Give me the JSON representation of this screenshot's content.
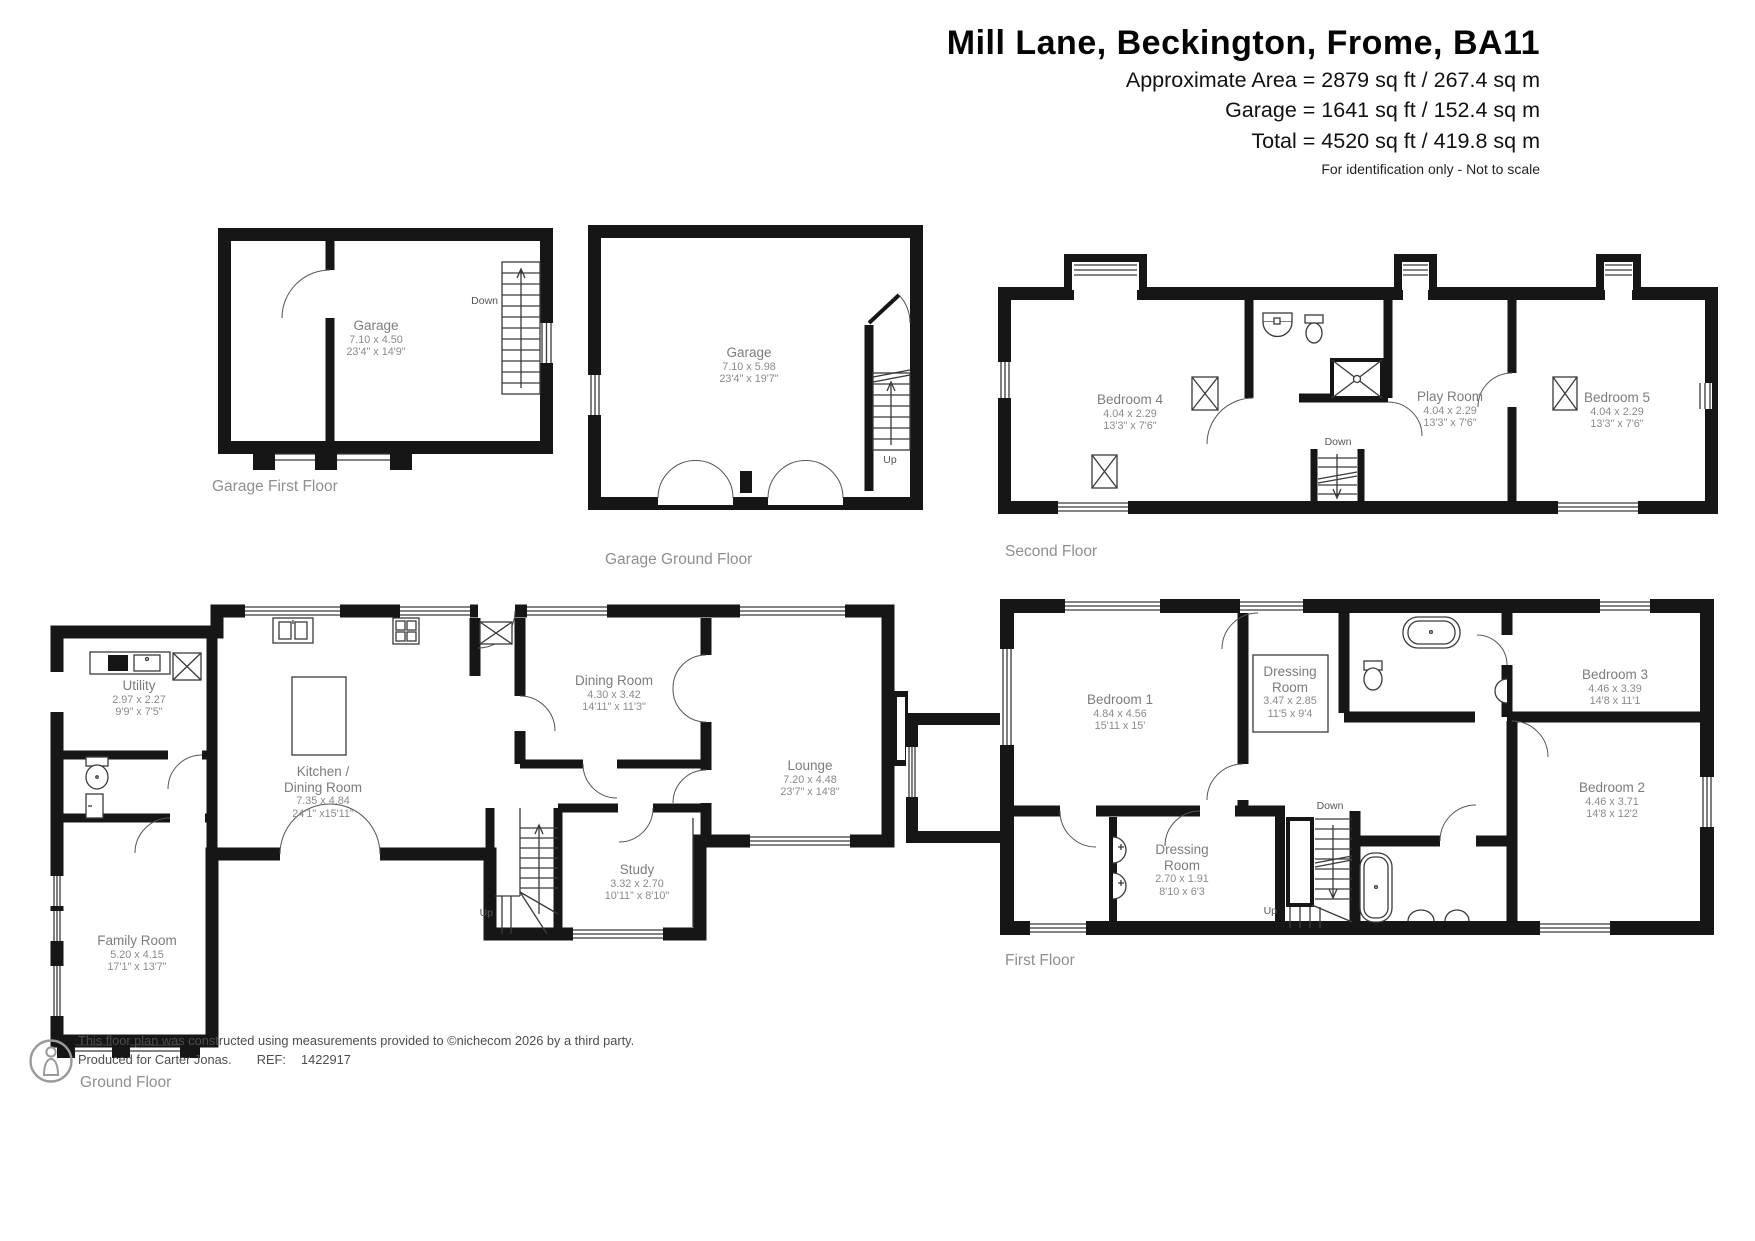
{
  "header": {
    "title": "Mill Lane, Beckington, Frome, BA11",
    "area_lines": [
      "Approximate Area = 2879 sq ft / 267.4 sq m",
      "Garage = 1641 sq ft / 152.4 sq m",
      "Total = 4520 sq ft / 419.8 sq m"
    ],
    "note": "For identification only - Not to scale"
  },
  "labels": {
    "up": "Up",
    "down": "Down"
  },
  "plans": {
    "garage_first_floor": {
      "caption": "Garage First Floor",
      "rooms": [
        {
          "line1": "Garage",
          "metric": "7.10 x 4.50",
          "imperial": "23'4\" x 14'9\""
        }
      ]
    },
    "garage_ground_floor": {
      "caption": "Garage Ground Floor",
      "rooms": [
        {
          "line1": "Garage",
          "metric": "7.10 x 5.98",
          "imperial": "23'4\" x 19'7\""
        }
      ]
    },
    "second_floor": {
      "caption": "Second Floor",
      "rooms": [
        {
          "line1": "Bedroom 4",
          "metric": "4.04 x 2.29",
          "imperial": "13'3\" x 7'6\""
        },
        {
          "line1": "Play Room",
          "metric": "4.04 x 2.29",
          "imperial": "13'3\" x 7'6\""
        },
        {
          "line1": "Bedroom 5",
          "metric": "4.04 x 2.29",
          "imperial": "13'3\" x 7'6\""
        }
      ]
    },
    "ground_floor": {
      "caption": "Ground Floor",
      "rooms": [
        {
          "line1": "Utility",
          "metric": "2.97 x 2.27",
          "imperial": "9'9\" x 7'5\""
        },
        {
          "line1": "Kitchen /",
          "line2": "Dining Room",
          "metric": "7.35 x 4.84",
          "imperial": "24'1\" x15'11\""
        },
        {
          "line1": "Dining Room",
          "metric": "4.30 x 3.42",
          "imperial": "14'11\" x 11'3\""
        },
        {
          "line1": "Lounge",
          "metric": "7.20 x 4.48",
          "imperial": "23'7\" x 14'8\""
        },
        {
          "line1": "Study",
          "metric": "3.32 x 2.70",
          "imperial": "10'11\" x 8'10\""
        },
        {
          "line1": "Family Room",
          "metric": "5.20 x 4.15",
          "imperial": "17'1\" x 13'7\""
        }
      ]
    },
    "first_floor": {
      "caption": "First Floor",
      "rooms": [
        {
          "line1": "Bedroom 1",
          "metric": "4.84 x 4.56",
          "imperial": "15'11 x 15'"
        },
        {
          "line1": "Dressing",
          "line2": "Room",
          "metric": "3.47 x 2.85",
          "imperial": "11'5 x 9'4"
        },
        {
          "line1": "Bedroom 3",
          "metric": "4.46 x 3.39",
          "imperial": "14'8 x 11'1"
        },
        {
          "line1": "Dressing",
          "line2": "Room",
          "metric": "2.70 x 1.91",
          "imperial": "8'10 x 6'3"
        },
        {
          "line1": "Bedroom 2",
          "metric": "4.46 x 3.71",
          "imperial": "14'8 x 12'2"
        }
      ]
    }
  },
  "footer": {
    "line1": "This floor plan was constructed using measurements provided to ©nichecom 2026 by a third party.",
    "line2_prefix": "Produced for Carter Jonas.",
    "ref_label": "REF:",
    "ref_value": "1422917"
  }
}
